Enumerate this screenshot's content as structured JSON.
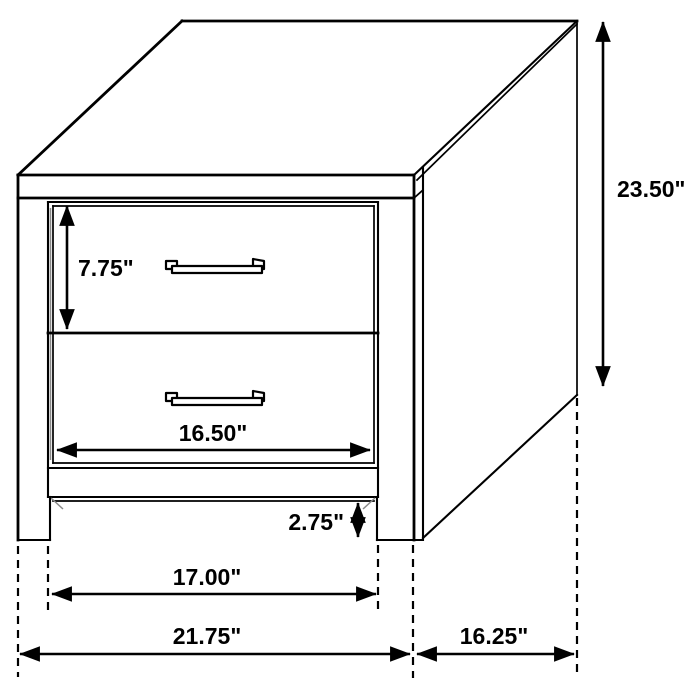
{
  "diagram": {
    "item": "two-drawer-nightstand",
    "style": {
      "background": "#ffffff",
      "line_color": "#000000",
      "text_color": "#000000"
    },
    "dimensions": {
      "overall_height": "23.50\"",
      "drawer_height": "7.75\"",
      "drawer_width": "16.50\"",
      "base_clearance": "2.75\"",
      "leg_inner_width": "17.00\"",
      "overall_width": "21.75\"",
      "overall_depth": "16.25\""
    }
  }
}
